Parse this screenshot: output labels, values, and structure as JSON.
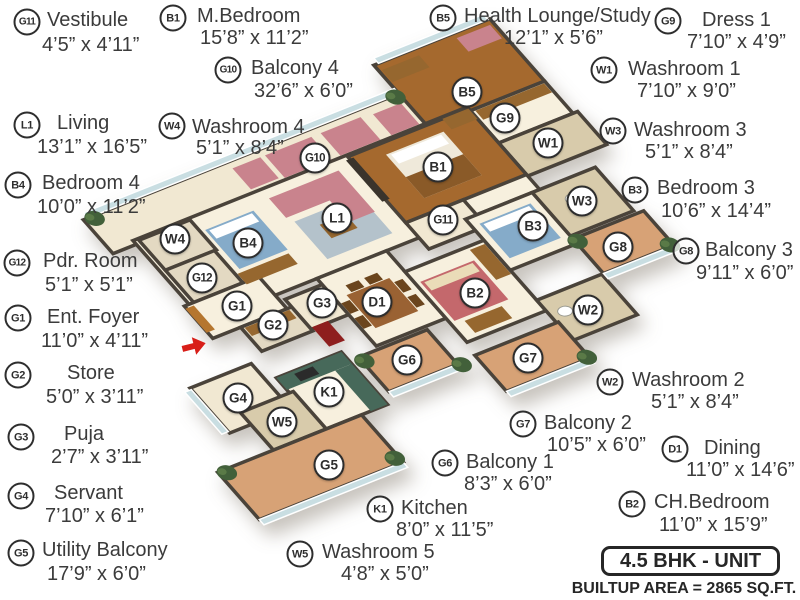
{
  "footer": {
    "unit_label": "4.5 BHK - UNIT",
    "builtup_label": "BUILTUP AREA = 2865 SQ.FT."
  },
  "entry_arrow": {
    "x": 194,
    "y": 346,
    "color": "#d81e18"
  },
  "colors": {
    "wall": "#4a433a",
    "cream": "#f7f0de",
    "cream2": "#f1e8d2",
    "wood": "#a5692e",
    "wood2": "#b5762f",
    "terra": "#d7a276",
    "tile": "#e3d9c2",
    "tileD": "#d8cbab",
    "pink": "#c9838d",
    "rug": "#b4c2cb",
    "blue": "#85abc9",
    "counter": "#47695a",
    "brown": "#96672f",
    "dbrown": "#6b451d",
    "red": "#8e1f1e",
    "glass": "#c9dee2",
    "green": "#42603a",
    "text": "#3b3b3b"
  },
  "rooms": [
    {
      "code": "G11",
      "name": "Vestibule",
      "dims": "4’5” x 4’11”",
      "legend": {
        "cx": 27,
        "cy": 22,
        "nx": 47,
        "ny": 21,
        "dx": 42,
        "dy": 46
      },
      "marker": {
        "x": 443,
        "y": 220
      }
    },
    {
      "code": "B1",
      "name": "M.Bedroom",
      "dims": "15’8” x 11’2”",
      "legend": {
        "cx": 173,
        "cy": 18,
        "nx": 197,
        "ny": 17,
        "dx": 200,
        "dy": 39
      },
      "marker": {
        "x": 438,
        "y": 167
      }
    },
    {
      "code": "B5",
      "name": "Health Lounge/Study",
      "dims": "12’1” x 5’6”",
      "legend": {
        "cx": 443,
        "cy": 18,
        "nx": 464,
        "ny": 17,
        "dx": 504,
        "dy": 39
      },
      "marker": {
        "x": 467,
        "y": 92
      }
    },
    {
      "code": "G9",
      "name": "Dress 1",
      "dims": "7’10” x 4’9”",
      "legend": {
        "cx": 668,
        "cy": 21,
        "nx": 702,
        "ny": 21,
        "dx": 687,
        "dy": 43
      },
      "marker": {
        "x": 505,
        "y": 118
      }
    },
    {
      "code": "G10",
      "name": "Balcony 4",
      "dims": "32’6” x 6’0”",
      "legend": {
        "cx": 228,
        "cy": 70,
        "nx": 251,
        "ny": 69,
        "dx": 254,
        "dy": 92
      },
      "marker": {
        "x": 315,
        "y": 158
      }
    },
    {
      "code": "W1",
      "name": "Washroom 1",
      "dims": "7’10” x 9’0”",
      "legend": {
        "cx": 604,
        "cy": 70,
        "nx": 628,
        "ny": 70,
        "dx": 637,
        "dy": 92
      },
      "marker": {
        "x": 548,
        "y": 143
      }
    },
    {
      "code": "L1",
      "name": "Living",
      "dims": "13’1” x 16’5”",
      "legend": {
        "cx": 27,
        "cy": 125,
        "nx": 57,
        "ny": 124,
        "dx": 37,
        "dy": 148
      },
      "marker": {
        "x": 337,
        "y": 218
      }
    },
    {
      "code": "W4",
      "name": "Washroom 4",
      "dims": "5’1” x 8’4”",
      "legend": {
        "cx": 172,
        "cy": 126,
        "nx": 192,
        "ny": 128,
        "dx": 196,
        "dy": 149
      },
      "marker": {
        "x": 175,
        "y": 239
      }
    },
    {
      "code": "W3",
      "name": "Washroom 3",
      "dims": "5’1” x 8’4”",
      "legend": {
        "cx": 613,
        "cy": 131,
        "nx": 634,
        "ny": 131,
        "dx": 645,
        "dy": 153
      },
      "marker": {
        "x": 582,
        "y": 201
      }
    },
    {
      "code": "B4",
      "name": "Bedroom 4",
      "dims": "10’0” x 11’2”",
      "legend": {
        "cx": 18,
        "cy": 185,
        "nx": 42,
        "ny": 184,
        "dx": 37,
        "dy": 208
      },
      "marker": {
        "x": 248,
        "y": 243
      }
    },
    {
      "code": "B3",
      "name": "Bedroom 3",
      "dims": "10’6” x 14’4”",
      "legend": {
        "cx": 635,
        "cy": 190,
        "nx": 657,
        "ny": 189,
        "dx": 661,
        "dy": 212
      },
      "marker": {
        "x": 533,
        "y": 226
      }
    },
    {
      "code": "G12",
      "name": "Pdr. Room",
      "dims": "5’1” x 5’1”",
      "legend": {
        "cx": 17,
        "cy": 263,
        "nx": 43,
        "ny": 262,
        "dx": 45,
        "dy": 286
      },
      "marker": {
        "x": 202,
        "y": 278
      }
    },
    {
      "code": "G8",
      "name": "Balcony 3",
      "dims": "9’11” x 6’0”",
      "legend": {
        "cx": 686,
        "cy": 251,
        "nx": 705,
        "ny": 251,
        "dx": 696,
        "dy": 274
      },
      "marker": {
        "x": 618,
        "y": 247
      }
    },
    {
      "code": "G1",
      "name": "Ent. Foyer",
      "dims": "11’0” x 4’11”",
      "legend": {
        "cx": 18,
        "cy": 318,
        "nx": 47,
        "ny": 318,
        "dx": 41,
        "dy": 342
      },
      "marker": {
        "x": 237,
        "y": 306
      }
    },
    {
      "code": "G2",
      "name": "Store",
      "dims": "5’0” x 3’11”",
      "legend": {
        "cx": 18,
        "cy": 375,
        "nx": 67,
        "ny": 374,
        "dx": 46,
        "dy": 398
      },
      "marker": {
        "x": 273,
        "y": 325
      }
    },
    {
      "code": "W2",
      "name": "Washroom 2",
      "dims": "5’1” x 8’4”",
      "legend": {
        "cx": 610,
        "cy": 382,
        "nx": 632,
        "ny": 381,
        "dx": 651,
        "dy": 403
      },
      "marker": {
        "x": 588,
        "y": 310
      }
    },
    {
      "code": "G3",
      "name": "Puja",
      "dims": "2’7” x 3’11”",
      "legend": {
        "cx": 21,
        "cy": 437,
        "nx": 64,
        "ny": 435,
        "dx": 51,
        "dy": 458
      },
      "marker": {
        "x": 322,
        "y": 303
      }
    },
    {
      "code": "G7",
      "name": "Balcony 2",
      "dims": "10’5” x 6’0”",
      "legend": {
        "cx": 523,
        "cy": 424,
        "nx": 544,
        "ny": 424,
        "dx": 547,
        "dy": 446
      },
      "marker": {
        "x": 528,
        "y": 358
      }
    },
    {
      "code": "D1",
      "name": "Dining",
      "dims": "11’0” x 14’6”",
      "legend": {
        "cx": 675,
        "cy": 449,
        "nx": 704,
        "ny": 449,
        "dx": 686,
        "dy": 471
      },
      "marker": {
        "x": 377,
        "y": 302
      }
    },
    {
      "code": "G4",
      "name": "Servant",
      "dims": "7’10” x 6’1”",
      "legend": {
        "cx": 21,
        "cy": 496,
        "nx": 54,
        "ny": 494,
        "dx": 45,
        "dy": 517
      },
      "marker": {
        "x": 238,
        "y": 398
      }
    },
    {
      "code": "G6",
      "name": "Balcony 1",
      "dims": "8’3” x 6’0”",
      "legend": {
        "cx": 445,
        "cy": 463,
        "nx": 466,
        "ny": 463,
        "dx": 464,
        "dy": 485
      },
      "marker": {
        "x": 407,
        "y": 360
      }
    },
    {
      "code": "B2",
      "name": "CH.Bedroom",
      "dims": "11’0” x 15’9”",
      "legend": {
        "cx": 632,
        "cy": 504,
        "nx": 654,
        "ny": 503,
        "dx": 659,
        "dy": 526
      },
      "marker": {
        "x": 475,
        "y": 293
      }
    },
    {
      "code": "G5",
      "name": "Utility Balcony",
      "dims": "17’9” x 6’0”",
      "legend": {
        "cx": 21,
        "cy": 553,
        "nx": 42,
        "ny": 551,
        "dx": 47,
        "dy": 575
      },
      "marker": {
        "x": 329,
        "y": 465
      }
    },
    {
      "code": "K1",
      "name": "Kitchen",
      "dims": "8’0” x 11’5”",
      "legend": {
        "cx": 380,
        "cy": 509,
        "nx": 401,
        "ny": 509,
        "dx": 396,
        "dy": 531
      },
      "marker": {
        "x": 329,
        "y": 392
      }
    },
    {
      "code": "W5",
      "name": "Washroom 5",
      "dims": "4’8” x 5’0”",
      "legend": {
        "cx": 300,
        "cy": 554,
        "nx": 322,
        "ny": 553,
        "dx": 341,
        "dy": 575
      },
      "marker": {
        "x": 282,
        "y": 422
      }
    }
  ]
}
